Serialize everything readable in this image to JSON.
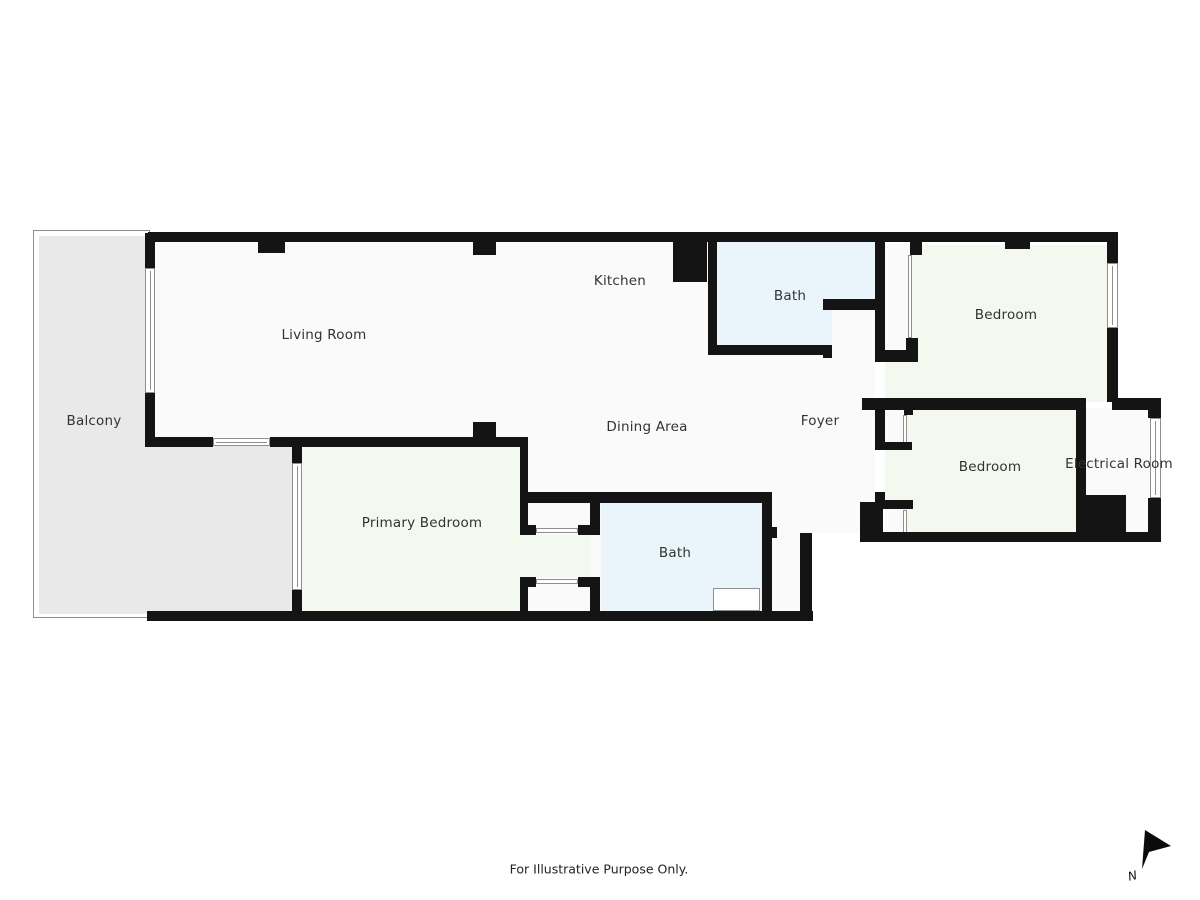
{
  "palette": {
    "wall": "#141414",
    "floor": "#fafafa",
    "balcony": "#e9e9e9",
    "bath": "#eaf5fb",
    "bedroom": "#f3f9ee",
    "line": "#8f8f8f",
    "text": "#333333"
  },
  "labels": [
    {
      "id": "balcony",
      "text": "Balcony",
      "x": 94,
      "y": 421
    },
    {
      "id": "living-room",
      "text": "Living Room",
      "x": 324,
      "y": 335
    },
    {
      "id": "kitchen",
      "text": "Kitchen",
      "x": 620,
      "y": 281
    },
    {
      "id": "bath-top",
      "text": "Bath",
      "x": 790,
      "y": 296
    },
    {
      "id": "bedroom-1",
      "text": "Bedroom",
      "x": 1006,
      "y": 315
    },
    {
      "id": "dining-area",
      "text": "Dining Area",
      "x": 647,
      "y": 427
    },
    {
      "id": "foyer",
      "text": "Foyer",
      "x": 820,
      "y": 421
    },
    {
      "id": "bedroom-2",
      "text": "Bedroom",
      "x": 990,
      "y": 467
    },
    {
      "id": "electrical-room",
      "text": "Electrical Room",
      "x": 1119,
      "y": 464
    },
    {
      "id": "primary-bedroom",
      "text": "Primary Bedroom",
      "x": 422,
      "y": 523
    },
    {
      "id": "bath-bottom",
      "text": "Bath",
      "x": 675,
      "y": 553
    }
  ],
  "footer": {
    "text": "For Illustrative Purpose Only."
  },
  "north": {
    "label": "N"
  },
  "fills": [
    {
      "name": "balcony-outline",
      "r": [
        33,
        230,
        117,
        388
      ],
      "c": null,
      "border": true
    },
    {
      "name": "balcony-fill",
      "r": [
        39,
        236,
        109,
        378
      ],
      "c": "balcony"
    },
    {
      "name": "balcony-fill-extension",
      "r": [
        148,
        446,
        145,
        166
      ],
      "c": "balcony"
    },
    {
      "name": "floor-living-dining",
      "r": [
        155,
        242,
        720,
        195
      ],
      "c": "floor"
    },
    {
      "name": "floor-hall-lower",
      "r": [
        528,
        437,
        284,
        175
      ],
      "c": "floor"
    },
    {
      "name": "floor-foyer-lower",
      "r": [
        812,
        437,
        63,
        96
      ],
      "c": "floor"
    },
    {
      "name": "floor-electrical-room",
      "r": [
        1086,
        408,
        65,
        125
      ],
      "c": "floor"
    },
    {
      "name": "room-fill-bath-top",
      "r": [
        717,
        242,
        158,
        103
      ],
      "c": "bath"
    },
    {
      "name": "floor-bath-alcove",
      "r": [
        832,
        310,
        43,
        52
      ],
      "c": "floor"
    },
    {
      "name": "room-fill-bath-bottom",
      "r": [
        601,
        503,
        161,
        108
      ],
      "c": "bath"
    },
    {
      "name": "room-fill-bedroom-1",
      "r": [
        885,
        245,
        222,
        157
      ],
      "c": "bedroom"
    },
    {
      "name": "room-fill-bedroom-2",
      "r": [
        885,
        408,
        191,
        125
      ],
      "c": "bedroom"
    },
    {
      "name": "room-fill-primary-bedroom",
      "r": [
        302,
        447,
        218,
        165
      ],
      "c": "bedroom"
    },
    {
      "name": "room-fill-dressing-hall",
      "r": [
        520,
        535,
        71,
        42
      ],
      "c": "bedroom"
    },
    {
      "name": "closet-primary-top",
      "r": [
        528,
        503,
        62,
        32
      ],
      "c": "floor"
    },
    {
      "name": "closet-primary-bottom",
      "r": [
        528,
        577,
        62,
        35
      ],
      "c": "floor"
    },
    {
      "name": "closet-bedroom-1",
      "r": [
        885,
        244,
        25,
        106
      ],
      "c": "floor"
    },
    {
      "name": "closet-bedroom-2-top",
      "r": [
        885,
        408,
        20,
        35
      ],
      "c": "floor"
    },
    {
      "name": "closet-bedroom-2-bottom",
      "r": [
        885,
        507,
        20,
        26
      ],
      "c": "floor"
    }
  ],
  "fronts": [
    {
      "name": "closet-front",
      "r": [
        536,
        528,
        42,
        5
      ]
    },
    {
      "name": "closet-front",
      "r": [
        536,
        579,
        42,
        5
      ]
    },
    {
      "name": "closet-front",
      "r": [
        908,
        255,
        4,
        83
      ]
    },
    {
      "name": "closet-front",
      "r": [
        903,
        415,
        4,
        28
      ]
    },
    {
      "name": "closet-front",
      "r": [
        903,
        510,
        4,
        23
      ]
    }
  ],
  "fixtures": [
    {
      "name": "bath-fixture",
      "r": [
        713,
        588,
        47,
        23
      ]
    }
  ],
  "walls": [
    [
      148,
      232,
      970,
      10
    ],
    [
      1107,
      232,
      11,
      31
    ],
    [
      1107,
      328,
      11,
      74
    ],
    [
      1148,
      398,
      13,
      20
    ],
    [
      1148,
      498,
      13,
      44
    ],
    [
      861,
      532,
      300,
      10
    ],
    [
      860,
      502,
      23,
      40
    ],
    [
      147,
      611,
      666,
      10
    ],
    [
      800,
      533,
      12,
      88
    ],
    [
      762,
      493,
      10,
      118
    ],
    [
      767,
      527,
      10,
      11
    ],
    [
      522,
      492,
      250,
      11
    ],
    [
      520,
      437,
      8,
      98
    ],
    [
      520,
      577,
      8,
      44
    ],
    [
      292,
      437,
      236,
      10
    ],
    [
      292,
      447,
      10,
      16
    ],
    [
      292,
      590,
      10,
      22
    ],
    [
      145,
      437,
      68,
      10
    ],
    [
      270,
      437,
      30,
      10
    ],
    [
      145,
      233,
      10,
      35
    ],
    [
      145,
      393,
      10,
      45
    ],
    [
      473,
      422,
      23,
      15
    ],
    [
      258,
      242,
      27,
      11
    ],
    [
      473,
      242,
      23,
      13
    ],
    [
      1005,
      242,
      25,
      7
    ],
    [
      673,
      235,
      34,
      47
    ],
    [
      708,
      242,
      9,
      113
    ],
    [
      708,
      345,
      124,
      10
    ],
    [
      823,
      345,
      9,
      13
    ],
    [
      823,
      299,
      62,
      11
    ],
    [
      875,
      242,
      10,
      120
    ],
    [
      875,
      350,
      43,
      12
    ],
    [
      906,
      338,
      12,
      24
    ],
    [
      910,
      242,
      12,
      13
    ],
    [
      862,
      398,
      216,
      12
    ],
    [
      1112,
      398,
      46,
      12
    ],
    [
      1076,
      398,
      10,
      97
    ],
    [
      1076,
      495,
      50,
      40
    ],
    [
      875,
      408,
      10,
      40
    ],
    [
      875,
      442,
      37,
      8
    ],
    [
      904,
      405,
      9,
      10
    ],
    [
      875,
      492,
      10,
      15
    ],
    [
      875,
      500,
      38,
      9
    ],
    [
      904,
      500,
      9,
      9
    ],
    [
      590,
      503,
      10,
      32
    ],
    [
      590,
      577,
      10,
      35
    ],
    [
      522,
      525,
      14,
      10
    ],
    [
      578,
      525,
      19,
      10
    ],
    [
      522,
      577,
      14,
      10
    ],
    [
      578,
      577,
      19,
      10
    ]
  ],
  "windows": [
    {
      "name": "window-living-room-balcony",
      "r": [
        145,
        268,
        10,
        125
      ]
    },
    {
      "name": "door-balcony-slider",
      "r": [
        213,
        438,
        57,
        8
      ]
    },
    {
      "name": "window-primary-bedroom-balcony",
      "r": [
        292,
        463,
        10,
        127
      ]
    },
    {
      "name": "window-bedroom-1",
      "r": [
        1107,
        263,
        11,
        65
      ]
    },
    {
      "name": "window-electrical-room",
      "r": [
        1150,
        418,
        11,
        80
      ]
    }
  ]
}
